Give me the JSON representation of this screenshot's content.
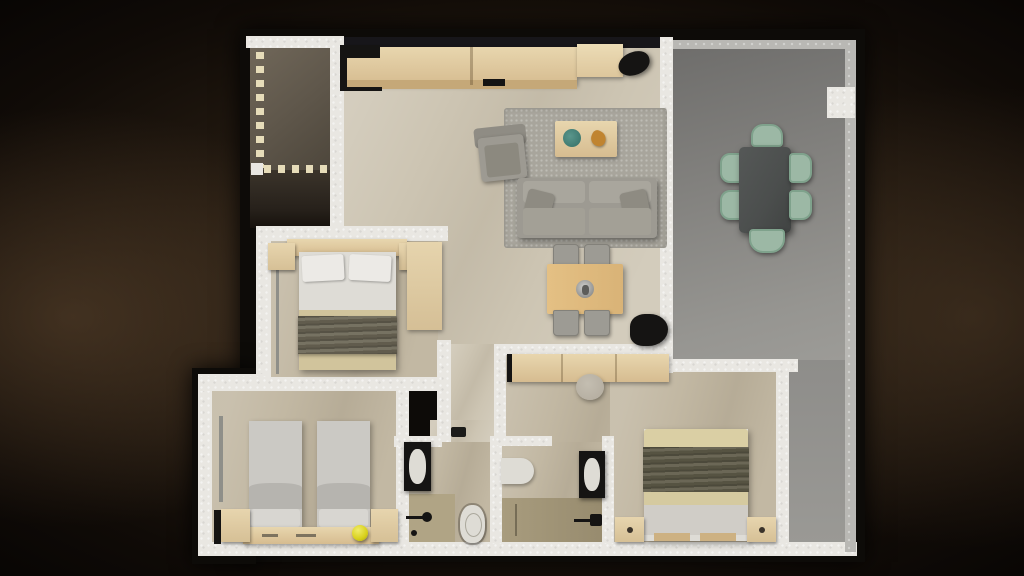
{
  "scene": {
    "kind": "3d-apartment-floor-plan-top-view",
    "background": "dark-brown-vignette",
    "rooms": [
      {
        "name": "entry-foyer",
        "position": "top-left",
        "floor": "dark-stone",
        "features": [
          "dashed-boundary-line"
        ]
      },
      {
        "name": "living-dining-kitchen",
        "position": "top-center",
        "floor": "beige-marble",
        "furniture": [
          "kitchen-counter",
          "black-appliance-module",
          "floor-plant",
          "area-rug",
          "armchair",
          "coffee-table",
          "sofa-with-pillows",
          "dining-table-4-chairs",
          "centerpiece",
          "floor-plant-2",
          "sideboard",
          "pouf"
        ]
      },
      {
        "name": "terrace",
        "position": "right",
        "floor": "gray-concrete",
        "furniture": [
          "outdoor-dining-table",
          "outdoor-chair-1",
          "outdoor-chair-2",
          "outdoor-chair-3",
          "outdoor-chair-4",
          "outdoor-chair-5",
          "outdoor-chair-6"
        ],
        "features": [
          "wall-pillar"
        ]
      },
      {
        "name": "bedroom-master",
        "position": "middle-left",
        "floor": "beige-marble",
        "furniture": [
          "double-bed",
          "headboard",
          "nightstand-left",
          "nightstand-right",
          "wardrobe",
          "two-pillows",
          "dark-throw-blanket"
        ]
      },
      {
        "name": "bedroom-twin",
        "position": "bottom-left",
        "floor": "beige-marble",
        "furniture": [
          "single-bed-1",
          "single-bed-2",
          "shared-headboard",
          "corner-unit-left",
          "corner-unit-right",
          "yellow-ball"
        ]
      },
      {
        "name": "hallway",
        "position": "center",
        "floor": "beige-marble",
        "furniture": []
      },
      {
        "name": "bathroom-1",
        "position": "bottom-center-left",
        "floor": "beige-tile",
        "furniture": [
          "vanity-black-counter",
          "white-basin",
          "toilet",
          "shower-tray",
          "shower-fixture"
        ]
      },
      {
        "name": "bathroom-2",
        "position": "bottom-center-right",
        "floor": "beige-tile",
        "furniture": [
          "bathtub-end",
          "vanity-black-counter",
          "white-basin",
          "shower-wet-floor",
          "shower-fixture"
        ]
      },
      {
        "name": "bedroom-second",
        "position": "bottom-right",
        "floor": "beige-marble",
        "furniture": [
          "double-bed",
          "olive-throw-blanket",
          "nightstand-left",
          "nightstand-right"
        ]
      }
    ]
  },
  "colors": {
    "wall": "#e9e7e2",
    "wall_gray": "#b9b8b4",
    "window_dark": "#17161a",
    "floor_beige": "#cdc5b3",
    "floor_beige_dark": "#c2b8a3",
    "dash": "#e6dcb9",
    "wood": "#d6bc90",
    "wood_light": "#e8d6ae",
    "wood_dark": "#c5a878",
    "rug": "#a8a59c",
    "sofa": "#9d9a92",
    "sofa_light": "#a9a69d",
    "chair_gray": "#9d9b94",
    "table_outdoor": "#4b4e4d",
    "chair_sage": "#9cb8a5",
    "bed_white": "#eceae6",
    "bed_sheet": "#dedcd6",
    "bed_tan": "#d1c49c",
    "throw_dark": "#6e6958",
    "olive": "#625e4b",
    "duvet": "#cbc9c4",
    "duvet_mid": "#b6b4af",
    "black": "#151413",
    "toilet_white": "#dedcd5",
    "shower_tray": "#b0a485",
    "wet_floor": "#a89c7e",
    "yellow": "#d8d01b",
    "teal": "#3f7a71",
    "orange": "#c08430",
    "pouf": "#b7b0a3"
  }
}
